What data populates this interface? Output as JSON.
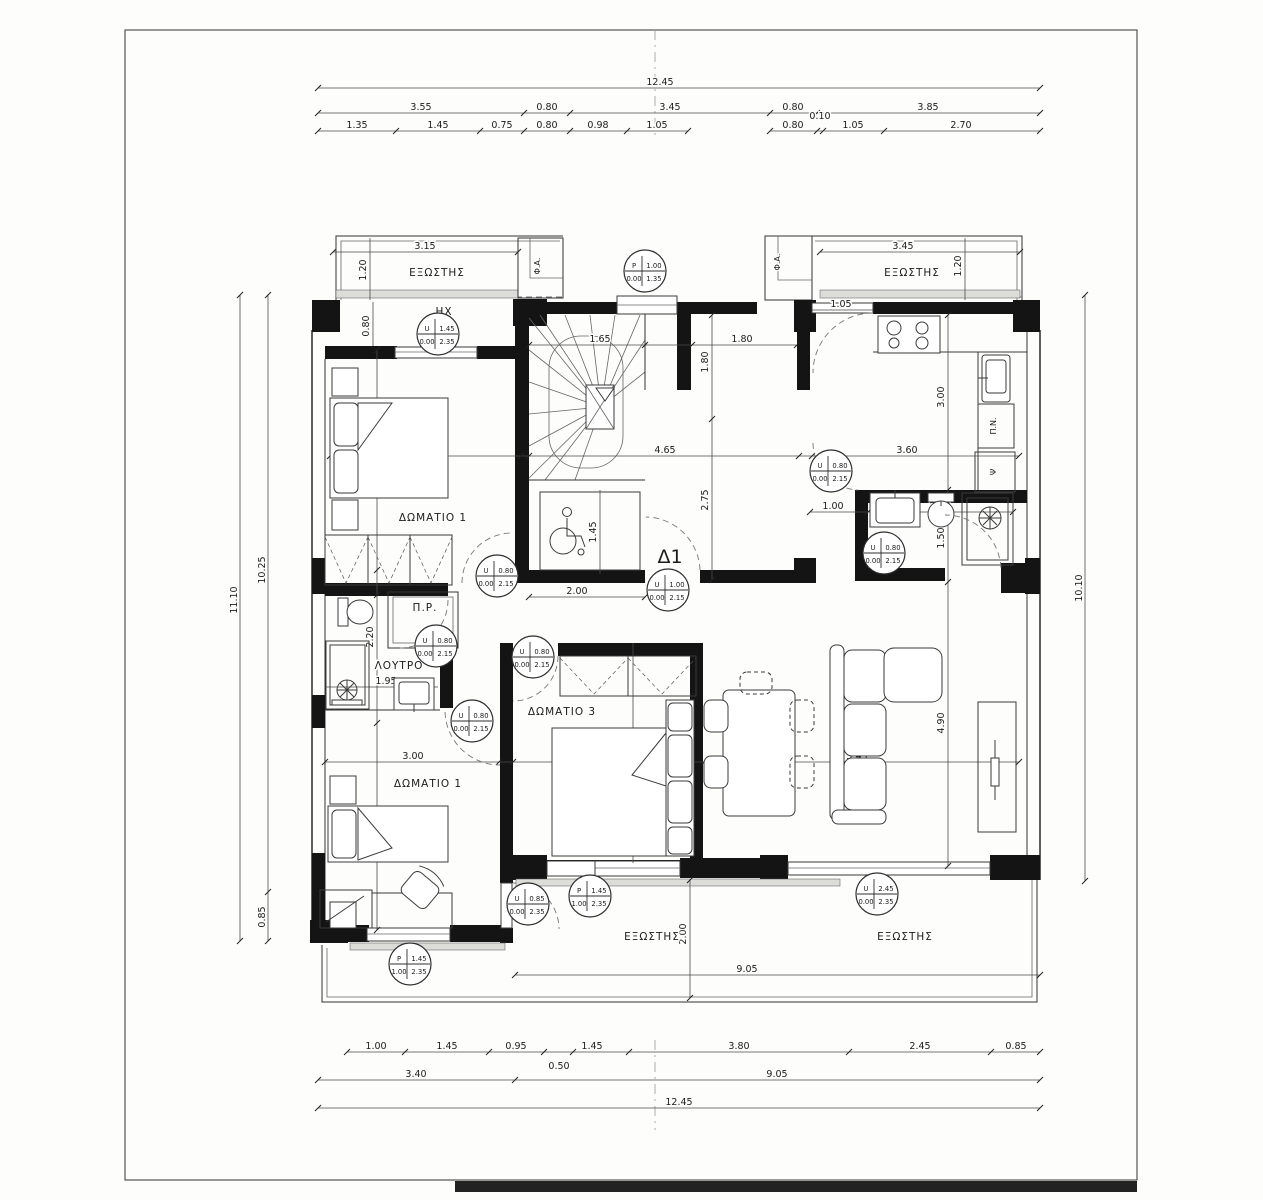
{
  "sheet": {
    "apartment_label": "Δ1"
  },
  "rooms": {
    "balcony": "ΕΞΩΣΤΗΣ",
    "bedroom1": "ΔΩΜΑΤΙΟ 1",
    "bedroom2": "ΔΩΜΑΤΙΟ 1",
    "bedroom3": "ΔΩΜΑΤΙΟ 3",
    "bathroom": "ΛΟΥΤΡΟ",
    "closet": "Π.Ρ.",
    "hx": "ΗΧ",
    "shaft": "Φ.Α.",
    "laundry": "Π.Ν.",
    "fridge": "Ψ"
  },
  "dims_top": {
    "total": "12.45",
    "row2": [
      "3.55",
      "0.80",
      "3.45",
      "0.80",
      "3.85"
    ],
    "row3": [
      "1.35",
      "1.45",
      "0.75",
      "0.80",
      "0.98",
      "1.05",
      "0.80",
      "0.10",
      "1.05",
      "2.70"
    ]
  },
  "dims_bottom": {
    "row1": [
      "1.00",
      "1.45",
      "0.95",
      "1.45",
      "3.80",
      "2.45",
      "0.85"
    ],
    "sub": "0.50",
    "row2": [
      "3.40",
      "9.05"
    ],
    "total": "12.45"
  },
  "dims_left": {
    "outer": "11.10",
    "inner": "10.25",
    "lower": "0.85"
  },
  "dims_right": {
    "total": "10.10"
  },
  "dims_in": {
    "balc_tl_w": "3.15",
    "balc_tl_d": "1.20",
    "wall_tl": "0.80",
    "balc_tr_w": "3.45",
    "balc_tr_d": "1.20",
    "kit_open": "1.05",
    "stair_w": "1.65",
    "nook_w": "1.80",
    "nook_h": "1.80",
    "hall_w": "4.65",
    "hall_h": "2.75",
    "alc_h": "1.45",
    "alc_w": "2.00",
    "kit_h": "3.00",
    "kit_w": "3.60",
    "bath_in": "1.00",
    "bath_w": "2.50",
    "bath_h": "1.50",
    "b1_w": "3.30",
    "b1_h": "3.80",
    "lt_h": "2.20",
    "lt_w": "1.95",
    "b2_w": "3.00",
    "b2_h": "3.70",
    "b3_w": "3.30",
    "b3_h": "3.80",
    "liv_w": "5.45",
    "liv_h": "4.90",
    "bb_d": "2.00",
    "bb_w": "9.05"
  },
  "tags": [
    {
      "letter": "U",
      "width": "1.45",
      "sill": "0.00",
      "height": "2.35"
    },
    {
      "letter": "P",
      "width": "1.00",
      "sill": "0.00",
      "height": "1.35"
    },
    {
      "letter": "U",
      "width": "0.80",
      "sill": "0.00",
      "height": "2.15"
    },
    {
      "letter": "U",
      "width": "0.80",
      "sill": "0.00",
      "height": "2.15"
    },
    {
      "letter": "U",
      "width": "0.80",
      "sill": "0.00",
      "height": "2.15"
    },
    {
      "letter": "U",
      "width": "0.80",
      "sill": "0.00",
      "height": "2.15"
    },
    {
      "letter": "U",
      "width": "0.80",
      "sill": "0.00",
      "height": "2.15"
    },
    {
      "letter": "U",
      "width": "0.80",
      "sill": "0.00",
      "height": "2.15"
    },
    {
      "letter": "U",
      "width": "1.00",
      "sill": "0.00",
      "height": "2.15"
    },
    {
      "letter": "P",
      "width": "1.45",
      "sill": "1.00",
      "height": "2.35"
    },
    {
      "letter": "U",
      "width": "0.85",
      "sill": "0.00",
      "height": "2.35"
    },
    {
      "letter": "P",
      "width": "1.45",
      "sill": "1.00",
      "height": "2.35"
    },
    {
      "letter": "U",
      "width": "2.45",
      "sill": "0.00",
      "height": "2.35"
    }
  ]
}
